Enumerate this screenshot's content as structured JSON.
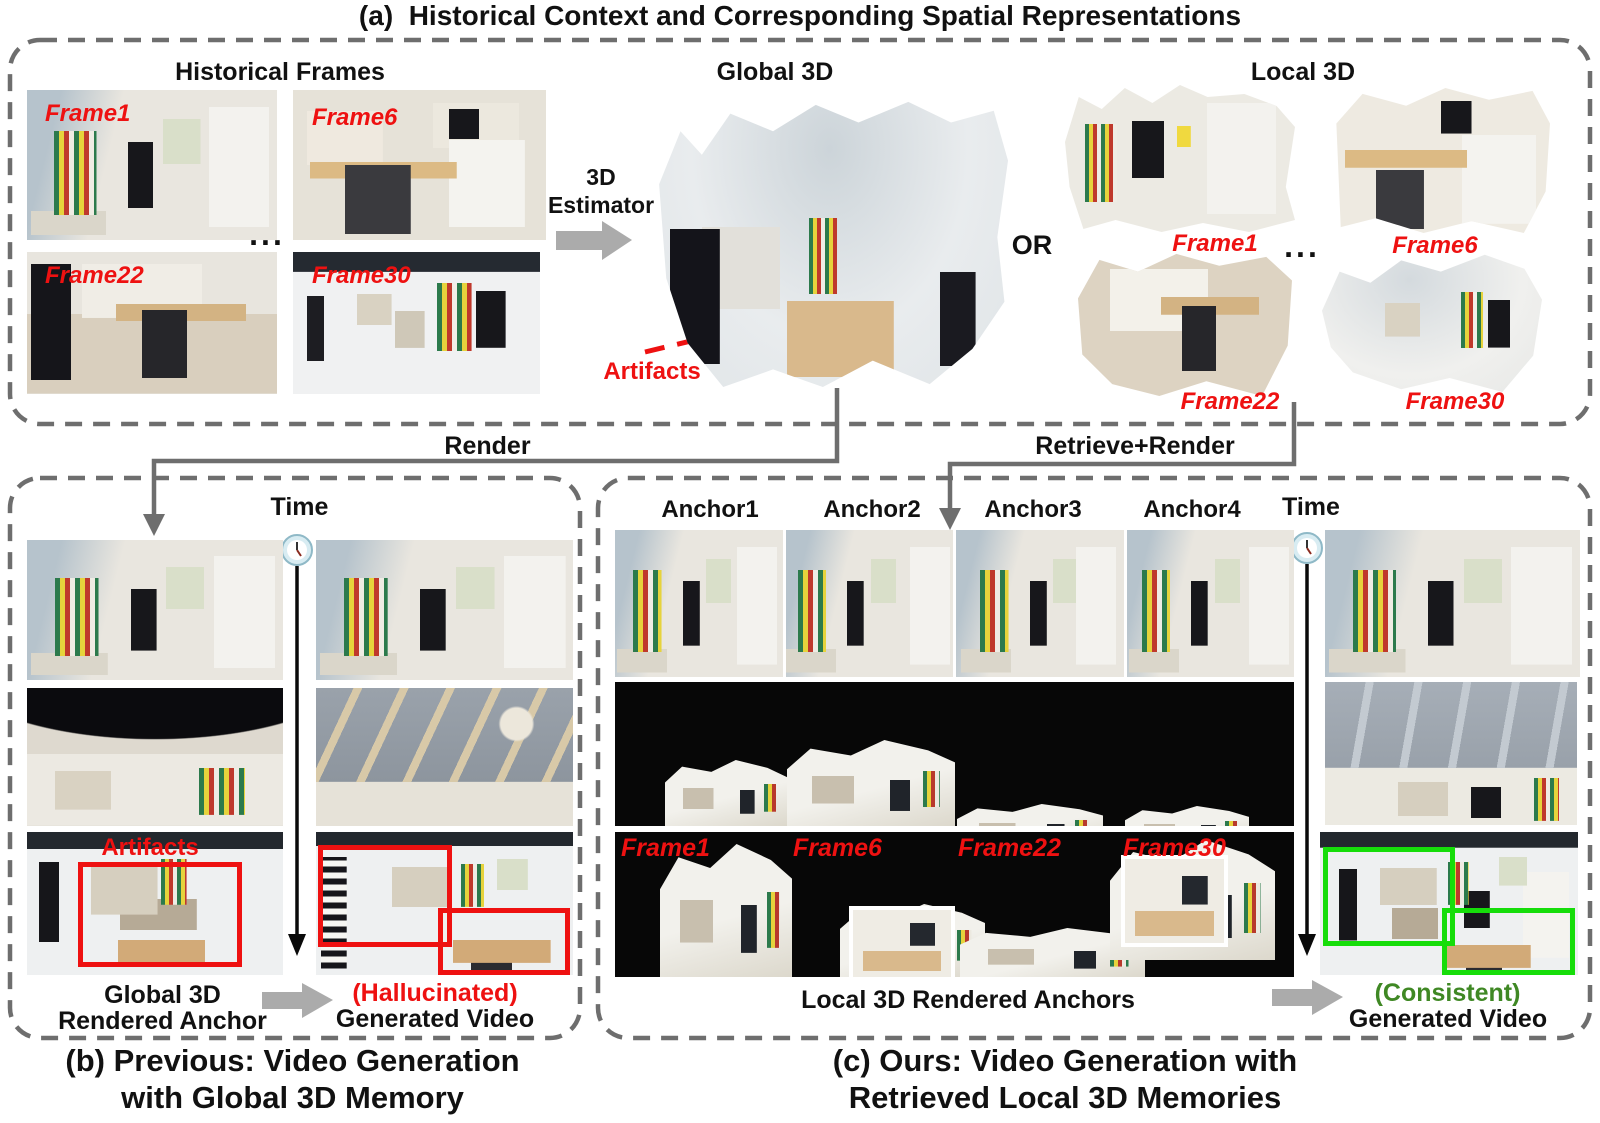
{
  "figure": {
    "panel_a": {
      "title": "(a)  Historical Context and Corresponding Spatial Representations",
      "historical_frames_title": "Historical Frames",
      "frame_labels": [
        "Frame1",
        "Frame6",
        "Frame22",
        "Frame30"
      ],
      "ellipsis": "...",
      "estimator_line1": "3D",
      "estimator_line2": "Estimator",
      "global_3d_title": "Global 3D",
      "artifacts_label": "Artifacts",
      "or_label": "OR",
      "local_3d_title": "Local 3D",
      "local_frame_labels": [
        "Frame1",
        "Frame6",
        "Frame22",
        "Frame30"
      ],
      "local_ellipsis": "..."
    },
    "connectors": {
      "render_label": "Render",
      "retrieve_render_label": "Retrieve+Render"
    },
    "panel_b": {
      "time_label": "Time",
      "artifacts_label": "Artifacts",
      "anchor_caption_line1": "Global 3D",
      "anchor_caption_line2": "Rendered Anchor",
      "video_caption_line1": "(Hallucinated)",
      "video_caption_line2": "Generated Video",
      "footer_line1": "(b) Previous: Video Generation",
      "footer_line2": "with Global 3D Memory"
    },
    "panel_c": {
      "anchor_labels": [
        "Anchor1",
        "Anchor2",
        "Anchor3",
        "Anchor4"
      ],
      "time_label": "Time",
      "frame_labels": [
        "Frame1",
        "Frame6",
        "Frame22",
        "Frame30"
      ],
      "anchors_caption": "Local 3D Rendered Anchors",
      "video_caption_line1": "(Consistent)",
      "video_caption_line2": "Generated Video",
      "footer_line1": "(c) Ours: Video Generation with",
      "footer_line2": "Retrieved Local 3D Memories"
    },
    "colors": {
      "red": "#ee1111",
      "green_box": "#16dd0a",
      "green_text": "#3f8824",
      "dash_gray": "#6e6e6e",
      "arrow_gray": "#ababab"
    }
  }
}
